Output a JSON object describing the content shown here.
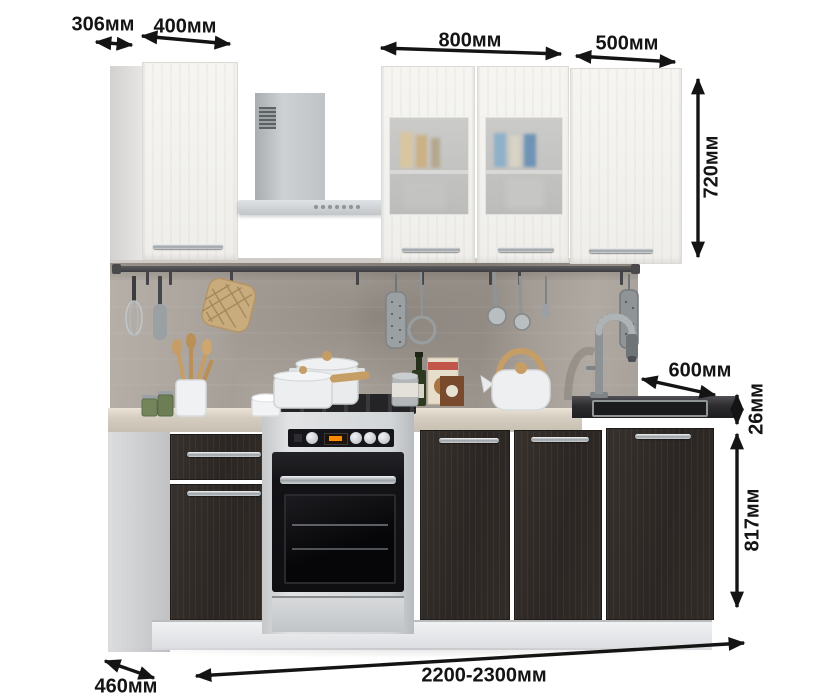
{
  "image": {
    "kind": "kitchen furniture dimension drawing",
    "language": "ru",
    "background": "#ffffff"
  },
  "dimensions": {
    "upper_cabinet_depth": "306мм",
    "wall_cabinet_left_width": "400мм",
    "wall_cabinet_glass_width": "800мм",
    "wall_cabinet_right_width": "500мм",
    "wall_cabinet_height": "720мм",
    "worktop_depth": "600мм",
    "worktop_thickness": "26мм",
    "base_cabinet_height": "817мм",
    "total_width": "2200-2300мм",
    "base_cabinet_depth": "460мм"
  },
  "annotation_style": {
    "color": "#141414",
    "arrow": "double-headed"
  },
  "palette": {
    "backsplash_concrete": "#aca69f",
    "upper_cabinet_wood": "#f4f3f0",
    "base_front_wenge": "#2f2a27",
    "worktop_light": "#d5cdc0",
    "sink_worktop_dark": "#2c2c2f",
    "hood_steel": "#c3c6c8",
    "stove_steel": "#d2d5d7",
    "oven_black": "#131316",
    "plinth_white": "#e9eaec",
    "wood_accent": "#c79d66",
    "display_orange": "#ff8a00"
  },
  "scene_parts": [
    "wall-cabinet-400",
    "range-hood",
    "wall-cabinet-800-glass",
    "wall-cabinet-500",
    "utensil-rail",
    "concrete-backsplash",
    "worktop",
    "sink-worktop",
    "faucet",
    "base-cabinet-400",
    "freestanding-stove",
    "base-cabinet-800",
    "sink-base-cabinet-600",
    "plinth",
    "cookware-pots",
    "kettle",
    "pot-holder",
    "wooden-utensils",
    "spice-jars",
    "grater",
    "ladles",
    "whisk",
    "oil-bottle",
    "food-boxes"
  ]
}
